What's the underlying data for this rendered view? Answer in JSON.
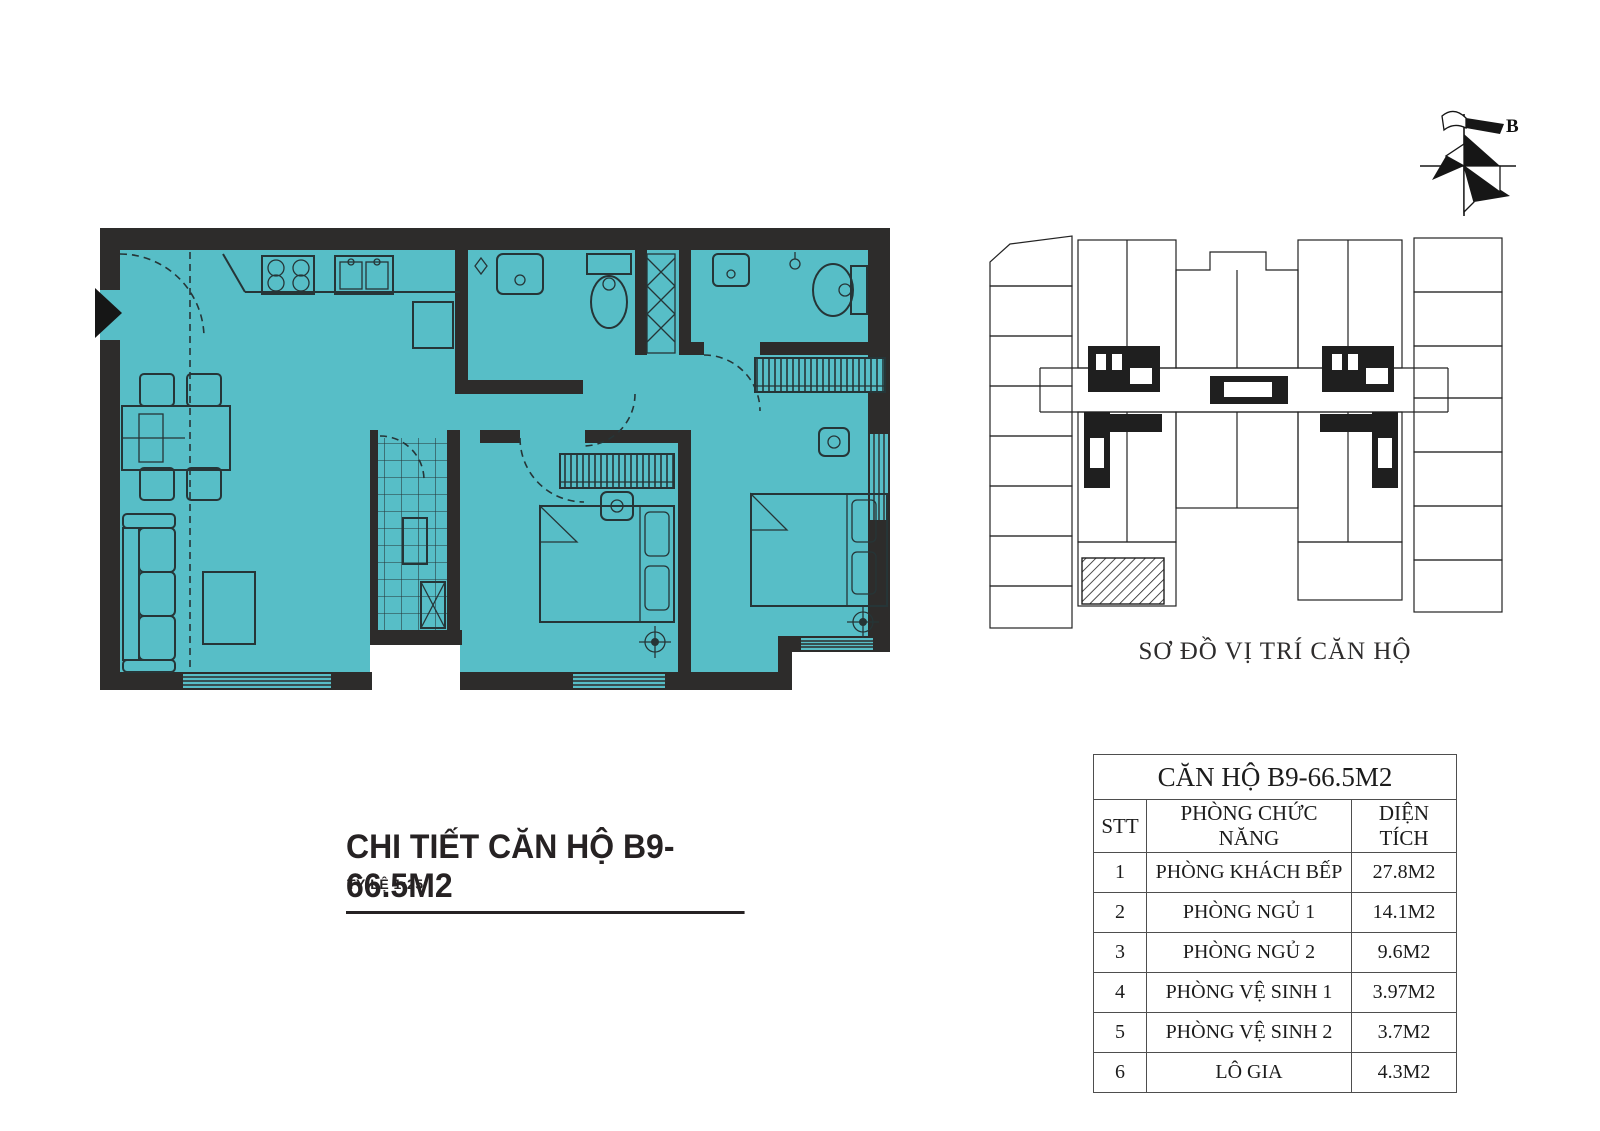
{
  "colors": {
    "floor": "#57bec7",
    "wall": "#2d2c2b",
    "line": "#263537",
    "accent_black": "#1c1c1c"
  },
  "detail_plan": {
    "title": "CHI TIẾT CĂN HỘ B9- 66.5M2",
    "scale_label": "TỶ LỆ  1:25"
  },
  "location_map": {
    "title": "SƠ ĐỒ VỊ TRÍ CĂN HỘ",
    "compass_label": "B"
  },
  "area_table": {
    "title": "CĂN HỘ B9-66.5M2",
    "headers": [
      "STT",
      "PHÒNG CHỨC NĂNG",
      "DIỆN TÍCH"
    ],
    "rows": [
      {
        "stt": "1",
        "room": "PHÒNG KHÁCH BẾP",
        "area": "27.8M2"
      },
      {
        "stt": "2",
        "room": "PHÒNG NGỦ 1",
        "area": "14.1M2"
      },
      {
        "stt": "3",
        "room": "PHÒNG NGỦ 2",
        "area": "9.6M2"
      },
      {
        "stt": "4",
        "room": "PHÒNG VỆ SINH 1",
        "area": "3.97M2"
      },
      {
        "stt": "5",
        "room": "PHÒNG VỆ SINH 2",
        "area": "3.7M2"
      },
      {
        "stt": "6",
        "room": "LÔ GIA",
        "area": "4.3M2"
      }
    ]
  }
}
